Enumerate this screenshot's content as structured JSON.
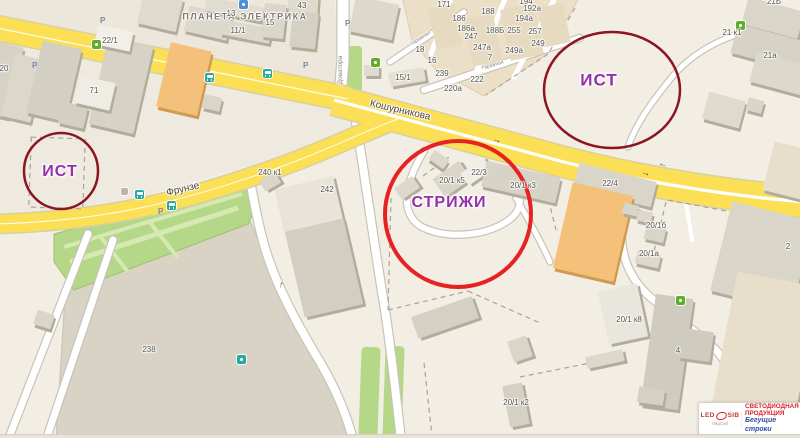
{
  "poi_title": {
    "text": "ПЛАНЕТА ЭЛЕКТРИКА",
    "x": 245,
    "y": 17
  },
  "annotations": {
    "purple": "#9430ab",
    "circles": [
      {
        "label": "ИСТ",
        "cx": 61,
        "cy": 171,
        "rx": 37,
        "ry": 38,
        "stroke": "#8c1520",
        "w": 2.5,
        "lx": 60,
        "ly": 172,
        "fs": 16
      },
      {
        "label": "ИСТ",
        "cx": 612,
        "cy": 90,
        "rx": 68,
        "ry": 58,
        "stroke": "#8c1520",
        "w": 2.5,
        "lx": 599,
        "ly": 80,
        "fs": 17
      },
      {
        "label": "СТРИЖИ",
        "cx": 458,
        "cy": 214,
        "rx": 73,
        "ry": 73,
        "stroke": "#e62222",
        "w": 4,
        "lx": 449,
        "ly": 203,
        "fs": 16
      }
    ]
  },
  "logo": {
    "brand_led": "LED",
    "brand_sib": "SIB",
    "tagline": "ЛедСиб",
    "line1": "СВЕТОДИОДНАЯ",
    "line2": "ПРОДУКЦИЯ",
    "line3": "Бегущие строки"
  },
  "map": {
    "palette": {
      "bg": "#f2eee4",
      "district": "#ece7da",
      "district2": "#efeadf",
      "lot": "#d8d3c4",
      "garage": "#ebe0c7",
      "green": "#b5d788",
      "green_path": "#d7e9b3",
      "yellow": "#fbdf55",
      "yellow_casing": "#d9d0a0",
      "white_casing": "#c8c3b8",
      "dash": "#a8a399",
      "shadow": "#b2ac9c"
    },
    "districts": [
      {
        "points": "0,0 334,0 346,97 0,26",
        "fill": "#ece7da"
      },
      {
        "points": "0,44 346,104 398,122 0,238",
        "fill": "#efeadf"
      }
    ],
    "lots": [
      {
        "name": "lot-238",
        "points": "66,280 248,216 266,258 300,324 340,392 352,440 56,440",
        "fill": "#d8d3c4",
        "stroke": "#c7c2b3"
      },
      {
        "name": "garage-area",
        "points": "402,-4 580,-4 570,14 546,55 484,96 436,70 412,40",
        "fill": "#ebe0c7",
        "stroke": "#dccfb0"
      }
    ],
    "green_polys": [
      {
        "name": "park",
        "points": "54,234 242,183 257,206 248,224 74,290 54,262",
        "fill": "#b5d788",
        "stroke": "#9fc06c"
      }
    ],
    "green_rects": [
      {
        "x": 360,
        "y": 347,
        "w": 19,
        "h": 92,
        "r": 2
      },
      {
        "x": 384,
        "y": 346,
        "w": 19,
        "h": 93,
        "r": 2
      },
      {
        "x": 348,
        "y": 46,
        "w": 14,
        "h": 47,
        "r": 0
      }
    ],
    "green_paths": [
      {
        "x1": 70,
        "y1": 262,
        "x2": 238,
        "y2": 208,
        "w": 5
      },
      {
        "x1": 64,
        "y1": 247,
        "x2": 242,
        "y2": 194,
        "w": 4
      },
      {
        "x1": 148,
        "y1": 220,
        "x2": 178,
        "y2": 258,
        "w": 4
      },
      {
        "x1": 100,
        "y1": 236,
        "x2": 128,
        "y2": 272,
        "w": 4
      }
    ],
    "roads_white": [
      {
        "name": "road-dovatora",
        "d": "M 343 -4 L 343 60 L 340 96",
        "w": 11
      },
      {
        "name": "road-south-1",
        "d": "M 249 176 C 256 210 260 236 270 263 C 282 297 302 332 320 362 C 334 386 346 412 353 440",
        "w": 8
      },
      {
        "name": "road-south-2",
        "d": "M 356 122 C 364 170 372 230 383 298 C 390 338 396 396 401 440",
        "w": 8
      },
      {
        "name": "road-sw-a",
        "d": "M 88 234 L 8 440",
        "w": 7
      },
      {
        "name": "road-sw-b",
        "d": "M 113 240 L 46 440",
        "w": 7
      },
      {
        "name": "road-se",
        "d": "M 628 186 C 614 238 622 272 650 297 C 676 318 700 334 716 350 C 736 372 741 400 738 436",
        "w": 7
      },
      {
        "name": "path-ne",
        "d": "M 804 20 C 740 28 700 44 672 77 C 650 104 636 124 628 147",
        "w": 5
      },
      {
        "name": "drive-loop",
        "d": "M 424 151 C 404 184 400 212 420 226 C 446 240 484 236 506 222 C 519 214 523 202 517 192",
        "w": 6
      },
      {
        "name": "drive-spur",
        "d": "M 516 198 C 530 222 542 244 550 262",
        "w": 5
      },
      {
        "name": "garage-street",
        "d": "M 424 90 L 580 38",
        "w": 6
      },
      {
        "name": "garage-street-2",
        "d": "M 390 62 L 464 12",
        "w": 5
      },
      {
        "name": "garage-lane",
        "d": "M 452 -4 L 431 54",
        "w": 5,
        "lane": true
      },
      {
        "name": "garage-lane",
        "d": "M 506 -4 L 473 80",
        "w": 5,
        "lane": true
      },
      {
        "name": "garage-lane",
        "d": "M 556 -4 L 514 77",
        "w": 5,
        "lane": true
      },
      {
        "name": "driveway",
        "d": "M 684 190 L 692 240",
        "w": 4,
        "lane": true
      }
    ],
    "roads_yellow": [
      {
        "name": "road-frunze-west",
        "d": "M -8 27 L 348 99",
        "w": 24,
        "center": 1.3
      },
      {
        "name": "road-frunze",
        "d": "M -6 224 C 120 221 200 195 280 167 C 330 149 365 131 398 119",
        "w": 18,
        "center": 1
      },
      {
        "name": "road-koshurnikova",
        "d": "M 334 100 C 380 113 450 132 560 161 C 650 184 730 196 806 202",
        "w": 30,
        "median": 3.2
      }
    ],
    "dashed_rects": [
      {
        "x": 30,
        "y": 138,
        "w": 54,
        "h": 70,
        "r": 2
      }
    ],
    "dashes": [
      {
        "x1": 423,
        "y1": 176,
        "x2": 449,
        "y2": 157
      },
      {
        "x1": 391,
        "y1": 198,
        "x2": 388,
        "y2": 310
      },
      {
        "x1": 388,
        "y1": 310,
        "x2": 468,
        "y2": 291
      },
      {
        "x1": 468,
        "y1": 291,
        "x2": 540,
        "y2": 323
      },
      {
        "x1": 544,
        "y1": 182,
        "x2": 556,
        "y2": 230
      },
      {
        "x1": 520,
        "y1": 377,
        "x2": 600,
        "y2": 361
      },
      {
        "x1": 424,
        "y1": 363,
        "x2": 432,
        "y2": 436
      },
      {
        "x1": 575,
        "y1": 8,
        "x2": 548,
        "y2": 54
      },
      {
        "x1": 548,
        "y1": 54,
        "x2": 486,
        "y2": 95
      },
      {
        "x1": 668,
        "y1": 200,
        "x2": 790,
        "y2": 223
      },
      {
        "x1": 666,
        "y1": 202,
        "x2": 650,
        "y2": 268
      }
    ],
    "buildings": [
      {
        "x": -10,
        "y": 44,
        "w": 26,
        "h": 72,
        "r": 13,
        "f": "#d6d2c5"
      },
      {
        "x": 8,
        "y": 56,
        "w": 30,
        "h": 64,
        "r": 13,
        "f": "#dbd7ca"
      },
      {
        "x": 34,
        "y": 44,
        "w": 40,
        "h": 74,
        "r": 13,
        "f": "#d3cfc2"
      },
      {
        "x": 60,
        "y": 104,
        "w": 26,
        "h": 22,
        "r": 13,
        "f": "#d3cfc2"
      },
      {
        "x": 98,
        "y": 40,
        "w": 46,
        "h": 90,
        "r": 13,
        "f": "#d6d2c5"
      },
      {
        "x": 77,
        "y": 79,
        "w": 36,
        "h": 28,
        "r": 13,
        "f": "#efece4"
      },
      {
        "x": 140,
        "y": -6,
        "w": 40,
        "h": 34,
        "r": 13,
        "f": "#dedacd"
      },
      {
        "x": 186,
        "y": 10,
        "w": 44,
        "h": 26,
        "r": 13,
        "f": "#dcd8cb"
      },
      {
        "x": 205,
        "y": 2,
        "w": 58,
        "h": 14,
        "r": 11,
        "f": "#e0dcd0"
      },
      {
        "x": 221,
        "y": 24,
        "w": 50,
        "h": 15,
        "r": 11,
        "f": "#dcd8cb"
      },
      {
        "x": 96,
        "y": 28,
        "w": 36,
        "h": 20,
        "r": 12,
        "f": "#f2efe7"
      },
      {
        "x": 163,
        "y": 46,
        "w": 42,
        "h": 66,
        "r": 13,
        "f": "#f3c179",
        "s": "#cf9a52"
      },
      {
        "x": 203,
        "y": 96,
        "w": 18,
        "h": 14,
        "r": 13,
        "f": "#d9d5c8"
      },
      {
        "x": 288,
        "y": -4,
        "w": 30,
        "h": 18,
        "r": 4,
        "f": "#dedacd"
      },
      {
        "x": 291,
        "y": 12,
        "w": 26,
        "h": 36,
        "r": 6,
        "f": "#d4d0c3"
      },
      {
        "x": 263,
        "y": 4,
        "w": 22,
        "h": 34,
        "r": 6,
        "f": "#dad6c9"
      },
      {
        "x": 352,
        "y": 0,
        "w": 44,
        "h": 36,
        "r": 12,
        "f": "#dcd8cb"
      },
      {
        "x": 389,
        "y": 70,
        "w": 36,
        "h": 14,
        "r": -10,
        "f": "#e3dfd3"
      },
      {
        "x": 364,
        "y": 65,
        "w": 15,
        "h": 11,
        "r": 0,
        "f": "#dfdbce"
      },
      {
        "x": 432,
        "y": 6,
        "w": 26,
        "h": 42,
        "r": -12,
        "f": "#e6dbc0",
        "ns": true
      },
      {
        "x": 468,
        "y": 16,
        "w": 30,
        "h": 48,
        "r": -12,
        "f": "#e6dbc0",
        "ns": true
      },
      {
        "x": 505,
        "y": 6,
        "w": 34,
        "h": 52,
        "r": -12,
        "f": "#e6dbc0",
        "ns": true
      },
      {
        "x": 541,
        "y": 5,
        "w": 26,
        "h": 40,
        "r": -12,
        "f": "#e6dbc0",
        "ns": true
      },
      {
        "x": 744,
        "y": 4,
        "w": 58,
        "h": 28,
        "r": 15,
        "f": "#d9d5c8"
      },
      {
        "x": 733,
        "y": 33,
        "w": 76,
        "h": 30,
        "r": 15,
        "f": "#d6d2c5"
      },
      {
        "x": 752,
        "y": 60,
        "w": 62,
        "h": 30,
        "r": 15,
        "f": "#dcd8cb"
      },
      {
        "x": 705,
        "y": 96,
        "w": 38,
        "h": 28,
        "r": 15,
        "f": "#dedacd"
      },
      {
        "x": 747,
        "y": 99,
        "w": 16,
        "h": 13,
        "r": 15,
        "f": "#d9d5c8"
      },
      {
        "x": 768,
        "y": 146,
        "w": 44,
        "h": 50,
        "r": 14,
        "f": "#e7decb"
      },
      {
        "x": 430,
        "y": 154,
        "w": 18,
        "h": 11,
        "r": 35,
        "f": "#dcd8cb"
      },
      {
        "x": 436,
        "y": 168,
        "w": 32,
        "h": 22,
        "r": -35,
        "f": "#d9d5c8"
      },
      {
        "x": 396,
        "y": 181,
        "w": 22,
        "h": 14,
        "r": -35,
        "f": "#dcd8cb"
      },
      {
        "x": 462,
        "y": 164,
        "w": 28,
        "h": 15,
        "r": -35,
        "f": "#f0ede5"
      },
      {
        "x": 483,
        "y": 169,
        "w": 76,
        "h": 26,
        "r": 13,
        "f": "#d7d3c6"
      },
      {
        "x": 575,
        "y": 172,
        "w": 80,
        "h": 26,
        "r": 14,
        "f": "#d9d5c8"
      },
      {
        "x": 562,
        "y": 188,
        "w": 62,
        "h": 88,
        "r": 13,
        "f": "#f3c179",
        "s": "#cf9a52"
      },
      {
        "x": 623,
        "y": 204,
        "w": 15,
        "h": 11,
        "r": 13,
        "f": "#d9d5c8"
      },
      {
        "x": 637,
        "y": 211,
        "w": 15,
        "h": 11,
        "r": 13,
        "f": "#dcd8cb"
      },
      {
        "x": 645,
        "y": 226,
        "w": 20,
        "h": 15,
        "r": 13,
        "f": "#d9d5c8"
      },
      {
        "x": 636,
        "y": 252,
        "w": 24,
        "h": 14,
        "r": 13,
        "f": "#dcd8cb"
      },
      {
        "x": 720,
        "y": 210,
        "w": 84,
        "h": 92,
        "r": 14,
        "f": "#d9d5c9"
      },
      {
        "x": 603,
        "y": 287,
        "w": 40,
        "h": 54,
        "r": -12,
        "f": "#e9e6dd"
      },
      {
        "x": 586,
        "y": 353,
        "w": 38,
        "h": 12,
        "r": -12,
        "f": "#dcd8cb"
      },
      {
        "x": 648,
        "y": 296,
        "w": 38,
        "h": 112,
        "r": 8,
        "f": "#cfcbbe"
      },
      {
        "x": 680,
        "y": 330,
        "w": 32,
        "h": 30,
        "r": 8,
        "f": "#cfcbbe"
      },
      {
        "x": 638,
        "y": 388,
        "w": 26,
        "h": 16,
        "r": 8,
        "f": "#d4d0c3"
      },
      {
        "x": 722,
        "y": 278,
        "w": 84,
        "h": 154,
        "r": 11,
        "f": "#e8dfcb"
      },
      {
        "x": 413,
        "y": 306,
        "w": 64,
        "h": 23,
        "r": -19,
        "f": "#d4d0c3"
      },
      {
        "x": 510,
        "y": 338,
        "w": 20,
        "h": 22,
        "r": -19,
        "f": "#d9d5c8"
      },
      {
        "x": 506,
        "y": 384,
        "w": 20,
        "h": 42,
        "r": -11,
        "f": "#d4d0c3"
      },
      {
        "x": 280,
        "y": 182,
        "w": 60,
        "h": 56,
        "r": -13,
        "f": "#e8e4da"
      },
      {
        "x": 294,
        "y": 224,
        "w": 60,
        "h": 88,
        "r": -13,
        "f": "#d2cec1"
      },
      {
        "x": 261,
        "y": 175,
        "w": 18,
        "h": 13,
        "r": -30,
        "f": "#d9d5c8"
      },
      {
        "x": 35,
        "y": 312,
        "w": 18,
        "h": 15,
        "r": 18,
        "f": "#d9d5c8"
      }
    ],
    "icons": [
      {
        "t": "bus",
        "x": 205,
        "y": 73
      },
      {
        "t": "bus",
        "x": 263,
        "y": 69
      },
      {
        "t": "bus",
        "x": 135,
        "y": 190
      },
      {
        "t": "bus",
        "x": 167,
        "y": 201
      },
      {
        "t": "green",
        "x": 92,
        "y": 40
      },
      {
        "t": "green",
        "x": 736,
        "y": 21
      },
      {
        "t": "green",
        "x": 371,
        "y": 58
      },
      {
        "t": "green",
        "x": 676,
        "y": 296
      },
      {
        "t": "blue",
        "x": 239,
        "y": 0
      },
      {
        "t": "teal",
        "x": 237,
        "y": 355
      },
      {
        "t": "gray",
        "x": 121,
        "y": 188
      },
      {
        "t": "p",
        "x": 100,
        "y": 16,
        "g": "P"
      },
      {
        "t": "p",
        "x": 32,
        "y": 61,
        "g": "P"
      },
      {
        "t": "p",
        "x": 345,
        "y": 19,
        "g": "P"
      },
      {
        "t": "p",
        "x": 303,
        "y": 61,
        "g": "P"
      },
      {
        "t": "p",
        "x": 158,
        "y": 207,
        "g": "P"
      }
    ],
    "arrows": [
      {
        "g": "←",
        "x": 663,
        "y": 164,
        "r": 13
      },
      {
        "g": "→",
        "x": 646,
        "y": 173,
        "r": 13
      },
      {
        "g": "→",
        "x": 497,
        "y": 140,
        "r": 13
      },
      {
        "g": "↑",
        "x": 281,
        "y": 285,
        "r": 16
      }
    ],
    "street_labels": [
      {
        "t": "Кошурникова",
        "x": 400,
        "y": 111,
        "r": 13,
        "s": 10
      },
      {
        "t": "Фрунзе",
        "x": 183,
        "y": 190,
        "r": -13,
        "s": 10
      },
      {
        "t": "Доватора",
        "x": 341,
        "y": 70,
        "r": -90,
        "s": 6.5,
        "sm": true
      },
      {
        "t": "Гаражная",
        "x": 493,
        "y": 66,
        "r": -17,
        "s": 5,
        "sm": true
      },
      {
        "t": "Гаражная",
        "x": 421,
        "y": 39,
        "r": -33,
        "s": 5,
        "sm": true
      }
    ],
    "number_labels": [
      {
        "t": "20",
        "x": 4,
        "y": 69
      },
      {
        "t": "22/1",
        "x": 110,
        "y": 41
      },
      {
        "t": "71",
        "x": 94,
        "y": 91
      },
      {
        "t": "13",
        "x": 231,
        "y": 14
      },
      {
        "t": "11/1",
        "x": 238,
        "y": 31
      },
      {
        "t": "43",
        "x": 302,
        "y": 6
      },
      {
        "t": "15",
        "x": 270,
        "y": 23
      },
      {
        "t": "15/1",
        "x": 403,
        "y": 78
      },
      {
        "t": "171",
        "x": 444,
        "y": 5
      },
      {
        "t": "188",
        "x": 488,
        "y": 12
      },
      {
        "t": "186",
        "x": 459,
        "y": 19
      },
      {
        "t": "186а",
        "x": 466,
        "y": 29
      },
      {
        "t": "188Б",
        "x": 495,
        "y": 31
      },
      {
        "t": "255",
        "x": 514,
        "y": 31
      },
      {
        "t": "257",
        "x": 535,
        "y": 32
      },
      {
        "t": "247",
        "x": 471,
        "y": 37
      },
      {
        "t": "247а",
        "x": 482,
        "y": 48
      },
      {
        "t": "249",
        "x": 538,
        "y": 44
      },
      {
        "t": "249а",
        "x": 514,
        "y": 51
      },
      {
        "t": "7",
        "x": 490,
        "y": 58
      },
      {
        "t": "18",
        "x": 420,
        "y": 50
      },
      {
        "t": "16",
        "x": 432,
        "y": 61
      },
      {
        "t": "239",
        "x": 442,
        "y": 74
      },
      {
        "t": "222",
        "x": 477,
        "y": 80
      },
      {
        "t": "220а",
        "x": 453,
        "y": 89
      },
      {
        "t": "194",
        "x": 526,
        "y": 2
      },
      {
        "t": "192а",
        "x": 532,
        "y": 9
      },
      {
        "t": "194а",
        "x": 524,
        "y": 19
      },
      {
        "t": "21Б",
        "x": 774,
        "y": 2
      },
      {
        "t": "21 к1",
        "x": 732,
        "y": 33
      },
      {
        "t": "21а",
        "x": 770,
        "y": 56
      },
      {
        "t": "240 к1",
        "x": 270,
        "y": 173
      },
      {
        "t": "242",
        "x": 327,
        "y": 190
      },
      {
        "t": "22/3",
        "x": 479,
        "y": 173
      },
      {
        "t": "20/1 к5",
        "x": 452,
        "y": 181
      },
      {
        "t": "20/1 к3",
        "x": 523,
        "y": 186
      },
      {
        "t": "22/4",
        "x": 610,
        "y": 184
      },
      {
        "t": "20/1б",
        "x": 656,
        "y": 226
      },
      {
        "t": "20/1а",
        "x": 649,
        "y": 254
      },
      {
        "t": "2",
        "x": 788,
        "y": 247
      },
      {
        "t": "20/1 к8",
        "x": 629,
        "y": 320
      },
      {
        "t": "4",
        "x": 678,
        "y": 351
      },
      {
        "t": "238",
        "x": 149,
        "y": 350
      },
      {
        "t": "20/1 к2",
        "x": 516,
        "y": 403
      }
    ]
  }
}
